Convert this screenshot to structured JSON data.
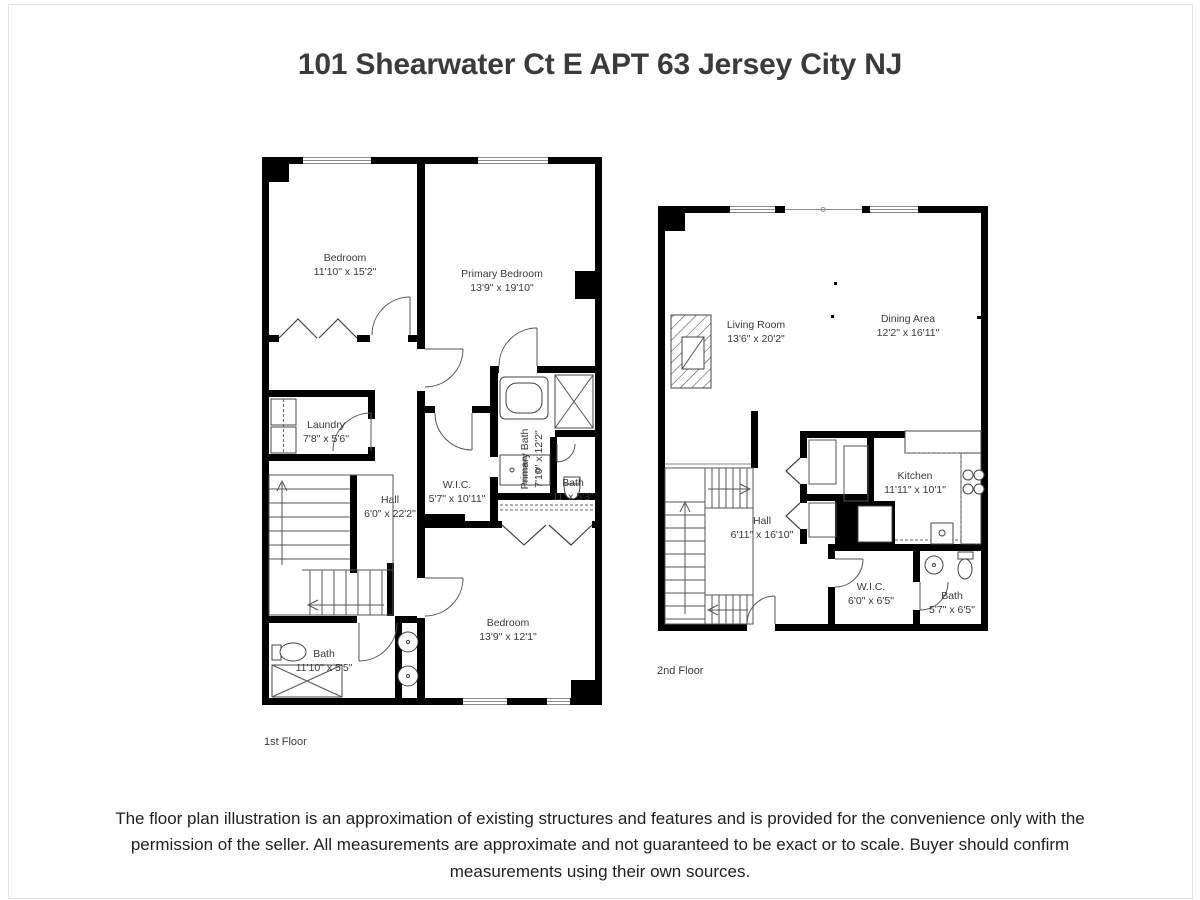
{
  "page": {
    "title": "101 Shearwater Ct E APT 63 Jersey City NJ",
    "disclaimer": "The floor plan illustration is an approximation of existing structures and features and is provided for the convenience only with the permission of the seller. All measurements are approximate and not guaranteed to be exact or to scale. Buyer should confirm measurements using their own sources.",
    "footnote_dot": "."
  },
  "colors": {
    "wall": "#000000",
    "label_text": "#3a3a3a",
    "fixture_line": "#555555",
    "window_line": "#8a8a8a"
  },
  "floors": [
    {
      "label": "1st Floor",
      "rooms": [
        {
          "name": "Bedroom",
          "dims": "11'10\" x 15'2\""
        },
        {
          "name": "Primary Bedroom",
          "dims": "13'9\" x 19'10\""
        },
        {
          "name": "Laundry",
          "dims": "7'8\" x 5'6\""
        },
        {
          "name": "Hall",
          "dims": "6'0\" x 22'2\""
        },
        {
          "name": "W.I.C.",
          "dims": "5'7\" x 10'11\""
        },
        {
          "name": "Primary Bath",
          "dims": "7'10\" x 12'2\""
        },
        {
          "name": "Bath",
          "dims": "11' x 5'3\""
        },
        {
          "name": "Bedroom",
          "dims": "13'9\" x 12'1\""
        },
        {
          "name": "Bath",
          "dims": "11'10\" x 5'5\""
        }
      ]
    },
    {
      "label": "2nd Floor",
      "rooms": [
        {
          "name": "Living Room",
          "dims": "13'6\" x 20'2\""
        },
        {
          "name": "Dining Area",
          "dims": "12'2\" x 16'11\""
        },
        {
          "name": "Kitchen",
          "dims": "11'11\" x 10'1\""
        },
        {
          "name": "Hall",
          "dims": "6'11\" x 16'10\""
        },
        {
          "name": "W.I.C.",
          "dims": "6'0\" x 6'5\""
        },
        {
          "name": "Bath",
          "dims": "5'7\" x 6'5\""
        }
      ]
    }
  ]
}
